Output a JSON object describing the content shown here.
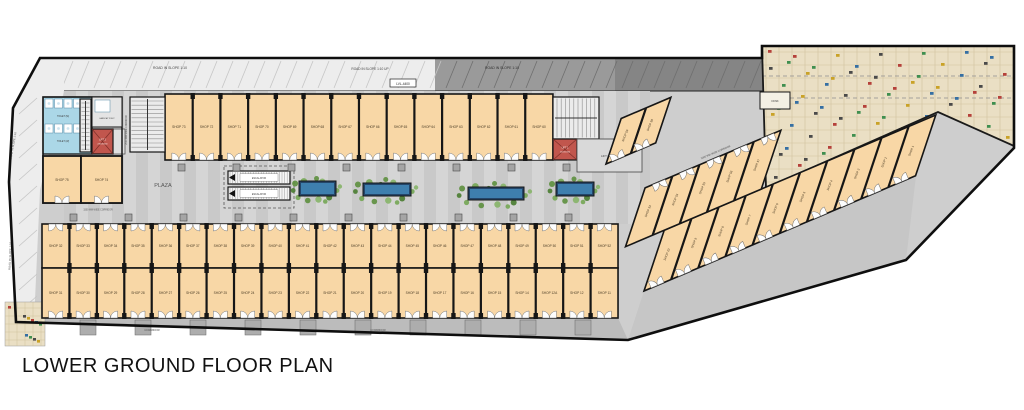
{
  "title": "LOWER GROUND FLOOR PLAN",
  "colors": {
    "shop_fill": "#f8d7a6",
    "wall": "#161616",
    "road_light": "#ededed",
    "road_dark": "#8f8f8f",
    "base_gray": "#cecece",
    "corridor_gray": "#bcbcbc",
    "toilet_blue": "#abd7e7",
    "lift_red": "#c1564d",
    "parking_beige": "#eadfc4",
    "parking_grid": "#cfc19d",
    "planter_green": "#5d8f3e",
    "water_blue": "#3e7fae",
    "car_marks": [
      "#b5413a",
      "#3f8f4f",
      "#c9a227",
      "#356fa3",
      "#4a4a4a"
    ]
  },
  "labels": {
    "road_top_left": "ROAD IN SLOPE 1:10",
    "road_top_up": "ROAD IN SLOPE 1:10 UP",
    "road_top_right": "ROAD IN SLOPE 1:10",
    "road_left_upper": "ROAD IN SLOPE 1:10",
    "road_left_lower": "ROAD IN SLOPE 1:10",
    "level_badge": "LVL-4400",
    "plaza": "PLAZA",
    "escalator": "ESCALATOR",
    "lift_lobby": "LIFT LOBBY",
    "lift_1_line1": "LIFT 1",
    "lift_1_line2": "2400X2400",
    "lift_2_line1": "LIFT 2",
    "lift_2_line2": "2300X2600",
    "toilet_m": "TOILET (M)",
    "toilet_w": "TOILET (W)",
    "handicap_toilet": "HANDICAP TOILET",
    "kiosk": "KIOSK",
    "corridor_3000": "3000 MM WIDE CORRIDOR",
    "corridor_2000": "2000 MM WIDE CORRIDOR",
    "corridor_1500": "1500 MM WIDE CORRIDOR",
    "corridor_left": "CORRIDOR",
    "corridor_right": "CORRIDOR"
  },
  "shops": {
    "left_block": [
      "SHOP 75",
      "SHOP 74"
    ],
    "top_row": [
      "SHOP 73",
      "SHOP 72",
      "SHOP 71",
      "SHOP 70",
      "SHOP 69",
      "SHOP 68",
      "SHOP 67",
      "SHOP 66",
      "SHOP 65",
      "SHOP 64",
      "SHOP 63",
      "SHOP 62",
      "SHOP 61",
      "SHOP 60"
    ],
    "plaza_row": [
      "SHOP 32",
      "SHOP 33",
      "SHOP 34",
      "SHOP 35",
      "SHOP 36",
      "SHOP 37",
      "SHOP 38",
      "SHOP 39",
      "SHOP 40",
      "SHOP 41",
      "SHOP 42",
      "SHOP 43",
      "SHOP 44",
      "SHOP 45",
      "SHOP 46",
      "SHOP 47",
      "SHOP 48",
      "SHOP 49",
      "SHOP 50",
      "SHOP 51",
      "SHOP 52"
    ],
    "lower_row": [
      "SHOP 31",
      "SHOP 30",
      "SHOP 29",
      "SHOP 28",
      "SHOP 27",
      "SHOP 26",
      "SHOP 25",
      "SHOP 24",
      "SHOP 23",
      "SHOP 22",
      "SHOP 21",
      "SHOP 20",
      "SHOP 19",
      "SHOP 18",
      "SHOP 17",
      "SHOP 16",
      "SHOP 15",
      "SHOP 14",
      "SHOP 12A",
      "SHOP 12",
      "SHOP 11"
    ],
    "near_lobby": [
      "SHOP 59",
      "SHOP 58"
    ],
    "diagonal_upper": [
      "SHOP 53",
      "SHOP 54",
      "SHOP 55",
      "SHOP 56",
      "SHOP 57"
    ],
    "diagonal_lower": [
      "SHOP 10",
      "SHOP 9",
      "SHOP 8",
      "SHOP 7",
      "SHOP 6",
      "SHOP 5",
      "SHOP 4",
      "SHOP 3",
      "SHOP 2",
      "SHOP 1"
    ]
  }
}
